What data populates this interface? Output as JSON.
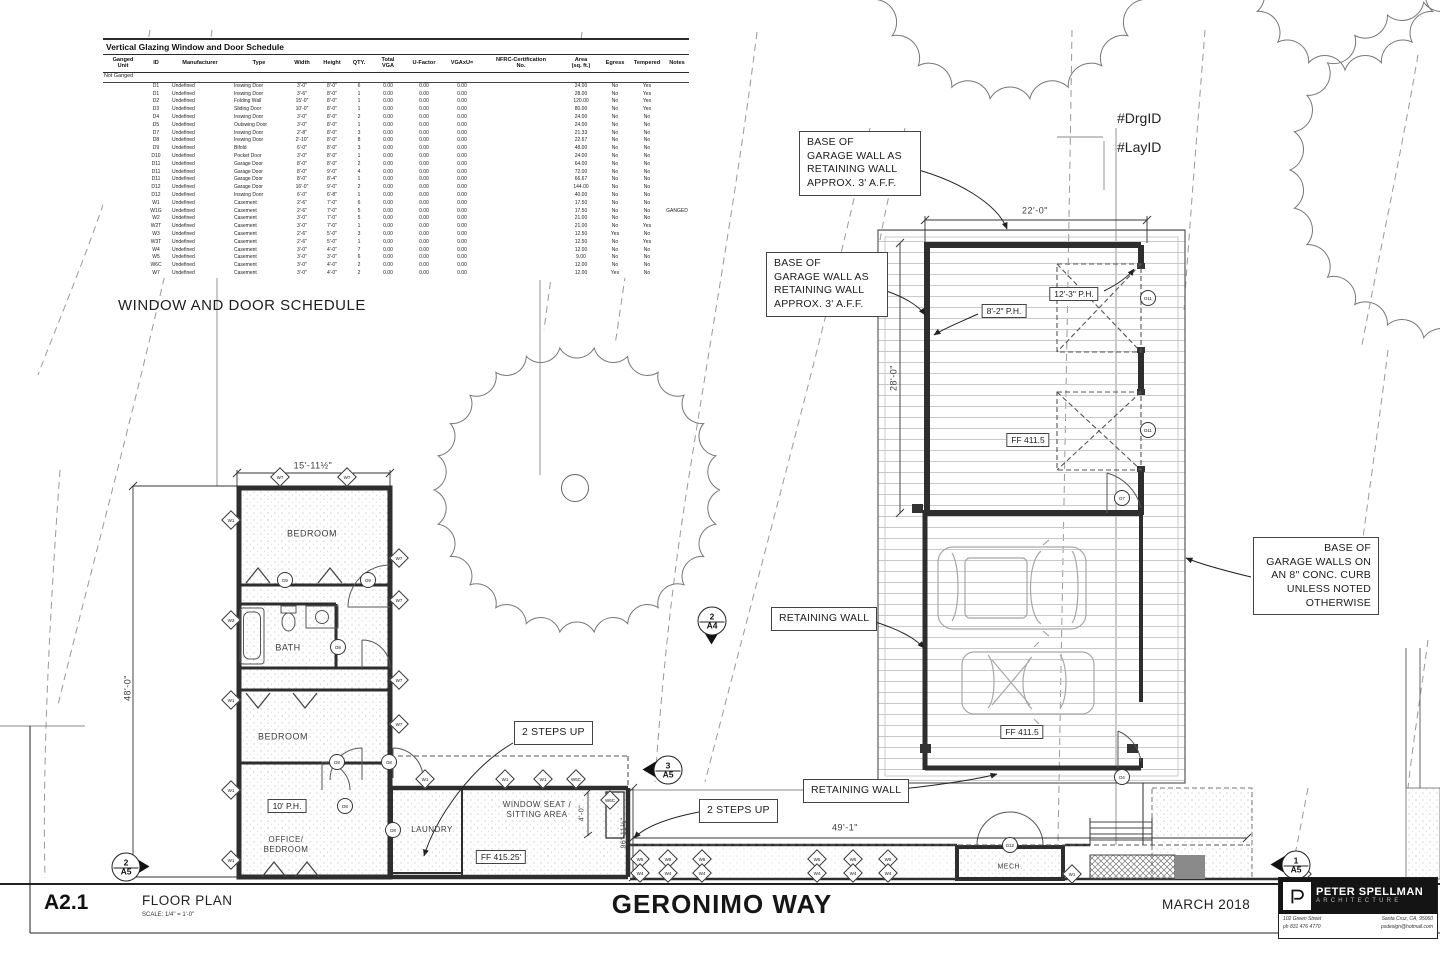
{
  "colors": {
    "ink": "#3a3a3a",
    "wall": "#2e2e2e",
    "light_line": "#c7c7c7",
    "black": "#111111"
  },
  "schedule": {
    "title": "Vertical Glazing Window and Door Schedule",
    "columns": [
      "Ganged\nUnit",
      "ID",
      "Manufacturer",
      "Type",
      "Width",
      "Height",
      "QTY.",
      "Total\nVGA",
      "U-Factor",
      "VGAxU=",
      "NFRC-Certification\nNo.",
      "Area\n(sq. ft.)",
      "Egress",
      "Tempered",
      "Notes"
    ],
    "group_label": "Not Ganged",
    "rows": [
      [
        "",
        "D1",
        "Undefined",
        "Inswing Door",
        "3'-0\"",
        "8'-0\"",
        "6",
        "0.00",
        "0.00",
        "0.00",
        "",
        "24.00",
        "No",
        "Yes",
        ""
      ],
      [
        "",
        "D1",
        "Undefined",
        "Inswing Door",
        "3'-6\"",
        "8'-0\"",
        "1",
        "0.00",
        "0.00",
        "0.00",
        "",
        "28.00",
        "No",
        "Yes",
        ""
      ],
      [
        "",
        "D2",
        "Undefined",
        "Folding Wall",
        "15'-0\"",
        "8'-0\"",
        "1",
        "0.00",
        "0.00",
        "0.00",
        "",
        "120.00",
        "No",
        "Yes",
        ""
      ],
      [
        "",
        "D3",
        "Undefined",
        "Sliding Door",
        "10'-0\"",
        "8'-0\"",
        "1",
        "0.00",
        "0.00",
        "0.00",
        "",
        "80.00",
        "No",
        "Yes",
        ""
      ],
      [
        "",
        "D4",
        "Undefined",
        "Inswing Door",
        "3'-0\"",
        "8'-0\"",
        "2",
        "0.00",
        "0.00",
        "0.00",
        "",
        "24.00",
        "No",
        "No",
        ""
      ],
      [
        "",
        "D5",
        "Undefined",
        "Outswing Door",
        "3'-0\"",
        "8'-0\"",
        "1",
        "0.00",
        "0.00",
        "0.00",
        "",
        "24.00",
        "No",
        "No",
        ""
      ],
      [
        "",
        "D7",
        "Undefined",
        "Inswing Door",
        "2'-8\"",
        "8'-0\"",
        "3",
        "0.00",
        "0.00",
        "0.00",
        "",
        "21.33",
        "No",
        "No",
        ""
      ],
      [
        "",
        "D8",
        "Undefined",
        "Inswing Door",
        "2'-10\"",
        "8'-0\"",
        "8",
        "0.00",
        "0.00",
        "0.00",
        "",
        "22.67",
        "No",
        "No",
        ""
      ],
      [
        "",
        "D9",
        "Undefined",
        "Bifold",
        "6'-0\"",
        "8'-0\"",
        "3",
        "0.00",
        "0.00",
        "0.00",
        "",
        "48.00",
        "No",
        "No",
        ""
      ],
      [
        "",
        "D10",
        "Undefined",
        "Pocket Door",
        "3'-0\"",
        "8'-0\"",
        "1",
        "0.00",
        "0.00",
        "0.00",
        "",
        "24.00",
        "No",
        "No",
        ""
      ],
      [
        "",
        "D11",
        "Undefined",
        "Garage Door",
        "8'-0\"",
        "8'-0\"",
        "2",
        "0.00",
        "0.00",
        "0.00",
        "",
        "64.00",
        "No",
        "No",
        ""
      ],
      [
        "",
        "D11",
        "Undefined",
        "Garage Door",
        "8'-0\"",
        "9'-0\"",
        "4",
        "0.00",
        "0.00",
        "0.00",
        "",
        "72.00",
        "No",
        "No",
        ""
      ],
      [
        "",
        "D11",
        "Undefined",
        "Garage Door",
        "8'-0\"",
        "8'-4\"",
        "1",
        "0.00",
        "0.00",
        "0.00",
        "",
        "66.67",
        "No",
        "No",
        ""
      ],
      [
        "",
        "D12",
        "Undefined",
        "Garage Door",
        "16'-0\"",
        "9'-0\"",
        "2",
        "0.00",
        "0.00",
        "0.00",
        "",
        "144.00",
        "No",
        "No",
        ""
      ],
      [
        "",
        "D12",
        "Undefined",
        "Inswing Door",
        "6'-0\"",
        "6'-8\"",
        "1",
        "0.00",
        "0.00",
        "0.00",
        "",
        "40.00",
        "No",
        "No",
        ""
      ],
      [
        "",
        "W1",
        "Undefined",
        "Casement",
        "2'-6\"",
        "7'-0\"",
        "6",
        "0.00",
        "0.00",
        "0.00",
        "",
        "17.50",
        "No",
        "No",
        ""
      ],
      [
        "",
        "W1G",
        "Undefined",
        "Casement",
        "2'-6\"",
        "7'-0\"",
        "5",
        "0.00",
        "0.00",
        "0.00",
        "",
        "17.50",
        "No",
        "No",
        "GANGED"
      ],
      [
        "",
        "W2",
        "Undefined",
        "Casement",
        "3'-0\"",
        "7'-0\"",
        "5",
        "0.00",
        "0.00",
        "0.00",
        "",
        "21.00",
        "No",
        "No",
        ""
      ],
      [
        "",
        "W2T",
        "Undefined",
        "Casement",
        "3'-0\"",
        "7'-0\"",
        "1",
        "0.00",
        "0.00",
        "0.00",
        "",
        "21.00",
        "No",
        "Yes",
        ""
      ],
      [
        "",
        "W3",
        "Undefined",
        "Casement",
        "2'-6\"",
        "5'-0\"",
        "3",
        "0.00",
        "0.00",
        "0.00",
        "",
        "12.50",
        "Yes",
        "No",
        ""
      ],
      [
        "",
        "W3T",
        "Undefined",
        "Casement",
        "2'-6\"",
        "5'-0\"",
        "1",
        "0.00",
        "0.00",
        "0.00",
        "",
        "12.50",
        "No",
        "Yes",
        ""
      ],
      [
        "",
        "W4",
        "Undefined",
        "Casement",
        "3'-0\"",
        "4'-0\"",
        "7",
        "0.00",
        "0.00",
        "0.00",
        "",
        "12.00",
        "No",
        "No",
        ""
      ],
      [
        "",
        "W5",
        "Undefined",
        "Casement",
        "3'-0\"",
        "3'-0\"",
        "6",
        "0.00",
        "0.00",
        "0.00",
        "",
        "9.00",
        "No",
        "No",
        ""
      ],
      [
        "",
        "W6C",
        "Undefined",
        "Casement",
        "3'-0\"",
        "4'-0\"",
        "2",
        "0.00",
        "0.00",
        "0.00",
        "",
        "12.00",
        "No",
        "No",
        ""
      ],
      [
        "",
        "W7",
        "Undefined",
        "Casement",
        "3'-0\"",
        "4'-0\"",
        "2",
        "0.00",
        "0.00",
        "0.00",
        "",
        "12.00",
        "Yes",
        "No",
        ""
      ]
    ]
  },
  "schedule_caption": "WINDOW AND DOOR SCHEDULE",
  "rooms": {
    "bedroom1": "BEDROOM",
    "bath": "BATH",
    "bedroom2": "BEDROOM",
    "office": "OFFICE/\nBEDROOM",
    "laundry": "LAUNDRY",
    "window_seat": "WINDOW SEAT /\nSITTING AREA",
    "mech": "MECH."
  },
  "dimensions": {
    "plan_width": "15'-11½\"",
    "plan_height": "48'-0\"",
    "garage_width": "22'-0\"",
    "garage_depth": "28'-0\"",
    "south_width": "49'-1\"",
    "east_height": "96'-11½\"",
    "seat_depth": "4'-0\""
  },
  "callouts": {
    "base_retaining": "BASE OF\nGARAGE WALL AS\nRETAINING WALL\nAPPROX. 3' A.F.F.",
    "curb": "BASE OF\nGARAGE WALLS ON\nAN 8\" CONC. CURB\nUNLESS NOTED\nOTHERWISE",
    "retaining": "RETAINING WALL",
    "steps": "2 STEPS UP",
    "ph_10": "10' P.H.",
    "ph_82": "8'-2\" P.H.",
    "ph_123": "12'-3\" P.H.",
    "ff_main": "FF 415.25'",
    "ff_garage": "FF 411.5",
    "drg_id": "#DrgID",
    "lay_id": "#LayID"
  },
  "section_markers": [
    {
      "num": "2",
      "sheet": "A5",
      "dir": "right",
      "x": 125,
      "y": 866
    },
    {
      "num": "2",
      "sheet": "A4",
      "dir": "down",
      "x": 711,
      "y": 620
    },
    {
      "num": "3",
      "sheet": "A5",
      "dir": "left",
      "x": 667,
      "y": 769
    },
    {
      "num": "1",
      "sheet": "A5",
      "dir": "left",
      "x": 1295,
      "y": 864
    }
  ],
  "plan_markers": {
    "diamonds": [
      {
        "x": 280,
        "y": 477,
        "l": "W7"
      },
      {
        "x": 347,
        "y": 477,
        "l": "W7"
      },
      {
        "x": 231,
        "y": 520,
        "l": "W1"
      },
      {
        "x": 231,
        "y": 620,
        "l": "W3"
      },
      {
        "x": 231,
        "y": 700,
        "l": "W1"
      },
      {
        "x": 231,
        "y": 790,
        "l": "W1"
      },
      {
        "x": 231,
        "y": 860,
        "l": "W1"
      },
      {
        "x": 399,
        "y": 558,
        "l": "W7"
      },
      {
        "x": 399,
        "y": 600,
        "l": "W7"
      },
      {
        "x": 399,
        "y": 680,
        "l": "W7"
      },
      {
        "x": 399,
        "y": 724,
        "l": "W7"
      },
      {
        "x": 425,
        "y": 779,
        "l": "W1"
      },
      {
        "x": 505,
        "y": 779,
        "l": "W1"
      },
      {
        "x": 543,
        "y": 779,
        "l": "W1"
      },
      {
        "x": 576,
        "y": 779,
        "l": "W6C"
      },
      {
        "x": 610,
        "y": 800,
        "l": "W6C"
      },
      {
        "x": 640,
        "y": 859,
        "l": "W5"
      },
      {
        "x": 640,
        "y": 873,
        "l": "W4"
      },
      {
        "x": 668,
        "y": 859,
        "l": "W5"
      },
      {
        "x": 668,
        "y": 873,
        "l": "W4"
      },
      {
        "x": 702,
        "y": 859,
        "l": "W5"
      },
      {
        "x": 702,
        "y": 873,
        "l": "W4"
      },
      {
        "x": 817,
        "y": 859,
        "l": "W5"
      },
      {
        "x": 817,
        "y": 873,
        "l": "W4"
      },
      {
        "x": 853,
        "y": 859,
        "l": "W5"
      },
      {
        "x": 853,
        "y": 873,
        "l": "W4"
      },
      {
        "x": 888,
        "y": 859,
        "l": "W5"
      },
      {
        "x": 888,
        "y": 873,
        "l": "W4"
      },
      {
        "x": 1072,
        "y": 874,
        "l": "W1"
      },
      {
        "x": 1302,
        "y": 874,
        "l": "W1"
      }
    ],
    "circles": [
      {
        "x": 285,
        "y": 580,
        "l": "D9"
      },
      {
        "x": 368,
        "y": 580,
        "l": "D9"
      },
      {
        "x": 338,
        "y": 647,
        "l": "D8"
      },
      {
        "x": 337,
        "y": 762,
        "l": "D8"
      },
      {
        "x": 389,
        "y": 762,
        "l": "D8"
      },
      {
        "x": 345,
        "y": 806,
        "l": "D8"
      },
      {
        "x": 393,
        "y": 830,
        "l": "D8"
      },
      {
        "x": 1010,
        "y": 845,
        "l": "D12"
      },
      {
        "x": 1148,
        "y": 298,
        "l": "D11"
      },
      {
        "x": 1148,
        "y": 430,
        "l": "D11"
      },
      {
        "x": 1122,
        "y": 498,
        "l": "D7"
      },
      {
        "x": 1122,
        "y": 777,
        "l": "D4"
      }
    ]
  },
  "titleblock": {
    "sheet_no": "A2.1",
    "drawing_title": "FLOOR PLAN",
    "scale": "SCALE: 1/4\"  =  1'-0\"",
    "project": "GERONIMO WAY",
    "date": "MARCH 2018",
    "firm_name": "PETER SPELLMAN",
    "firm_sub": "ARCHITECTURE",
    "addr1": "102 Green Street",
    "addr2": "ph 831 476 4770",
    "addr3": "Santa Cruz, CA, 95060",
    "addr4": "psdesign@hotmail.com"
  }
}
